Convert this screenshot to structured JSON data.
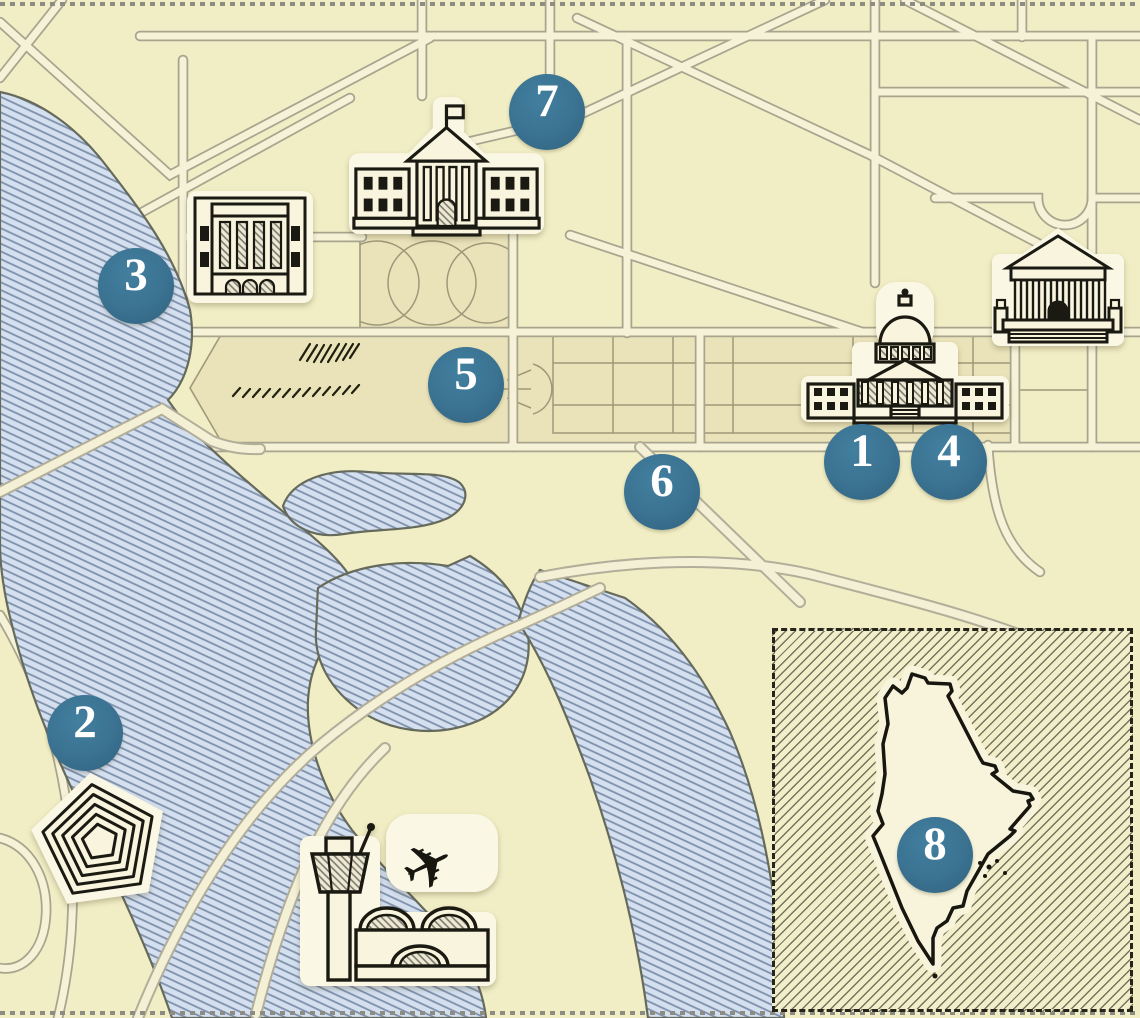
{
  "map_title": "illustrated-washington-dc-landmarks-map",
  "markers": [
    {
      "label": "1"
    },
    {
      "label": "2"
    },
    {
      "label": "3"
    },
    {
      "label": "4"
    },
    {
      "label": "5"
    },
    {
      "label": "6"
    },
    {
      "label": "7"
    },
    {
      "label": "8"
    }
  ],
  "icons": [
    {
      "name": "capitol-icon"
    },
    {
      "name": "pentagon-icon"
    },
    {
      "name": "federal-building-icon"
    },
    {
      "name": "supreme-court-icon"
    },
    {
      "name": "white-house-icon"
    },
    {
      "name": "airport-icon"
    },
    {
      "name": "airplane-icon"
    },
    {
      "name": "maine-state-outline"
    }
  ],
  "airplane_glyph": "✈",
  "colors": {
    "background": "#f1edc5",
    "panel": "#eae3ba",
    "road_fill": "#f6f2d8",
    "road_casing": "#a8a48e",
    "water_fill": "#d4dfef",
    "water_hatch": "#7e91aa",
    "shore": "#666a5b",
    "marker": "#3b7291",
    "marker_text": "#ffffff",
    "ink": "#1b1a12",
    "sticker_halo": "#faf7e5",
    "inset_hatch": "#525042",
    "border_dots": "#8d8c83"
  },
  "inset": {
    "style": "diagonal-hatched",
    "border": "dashed"
  }
}
